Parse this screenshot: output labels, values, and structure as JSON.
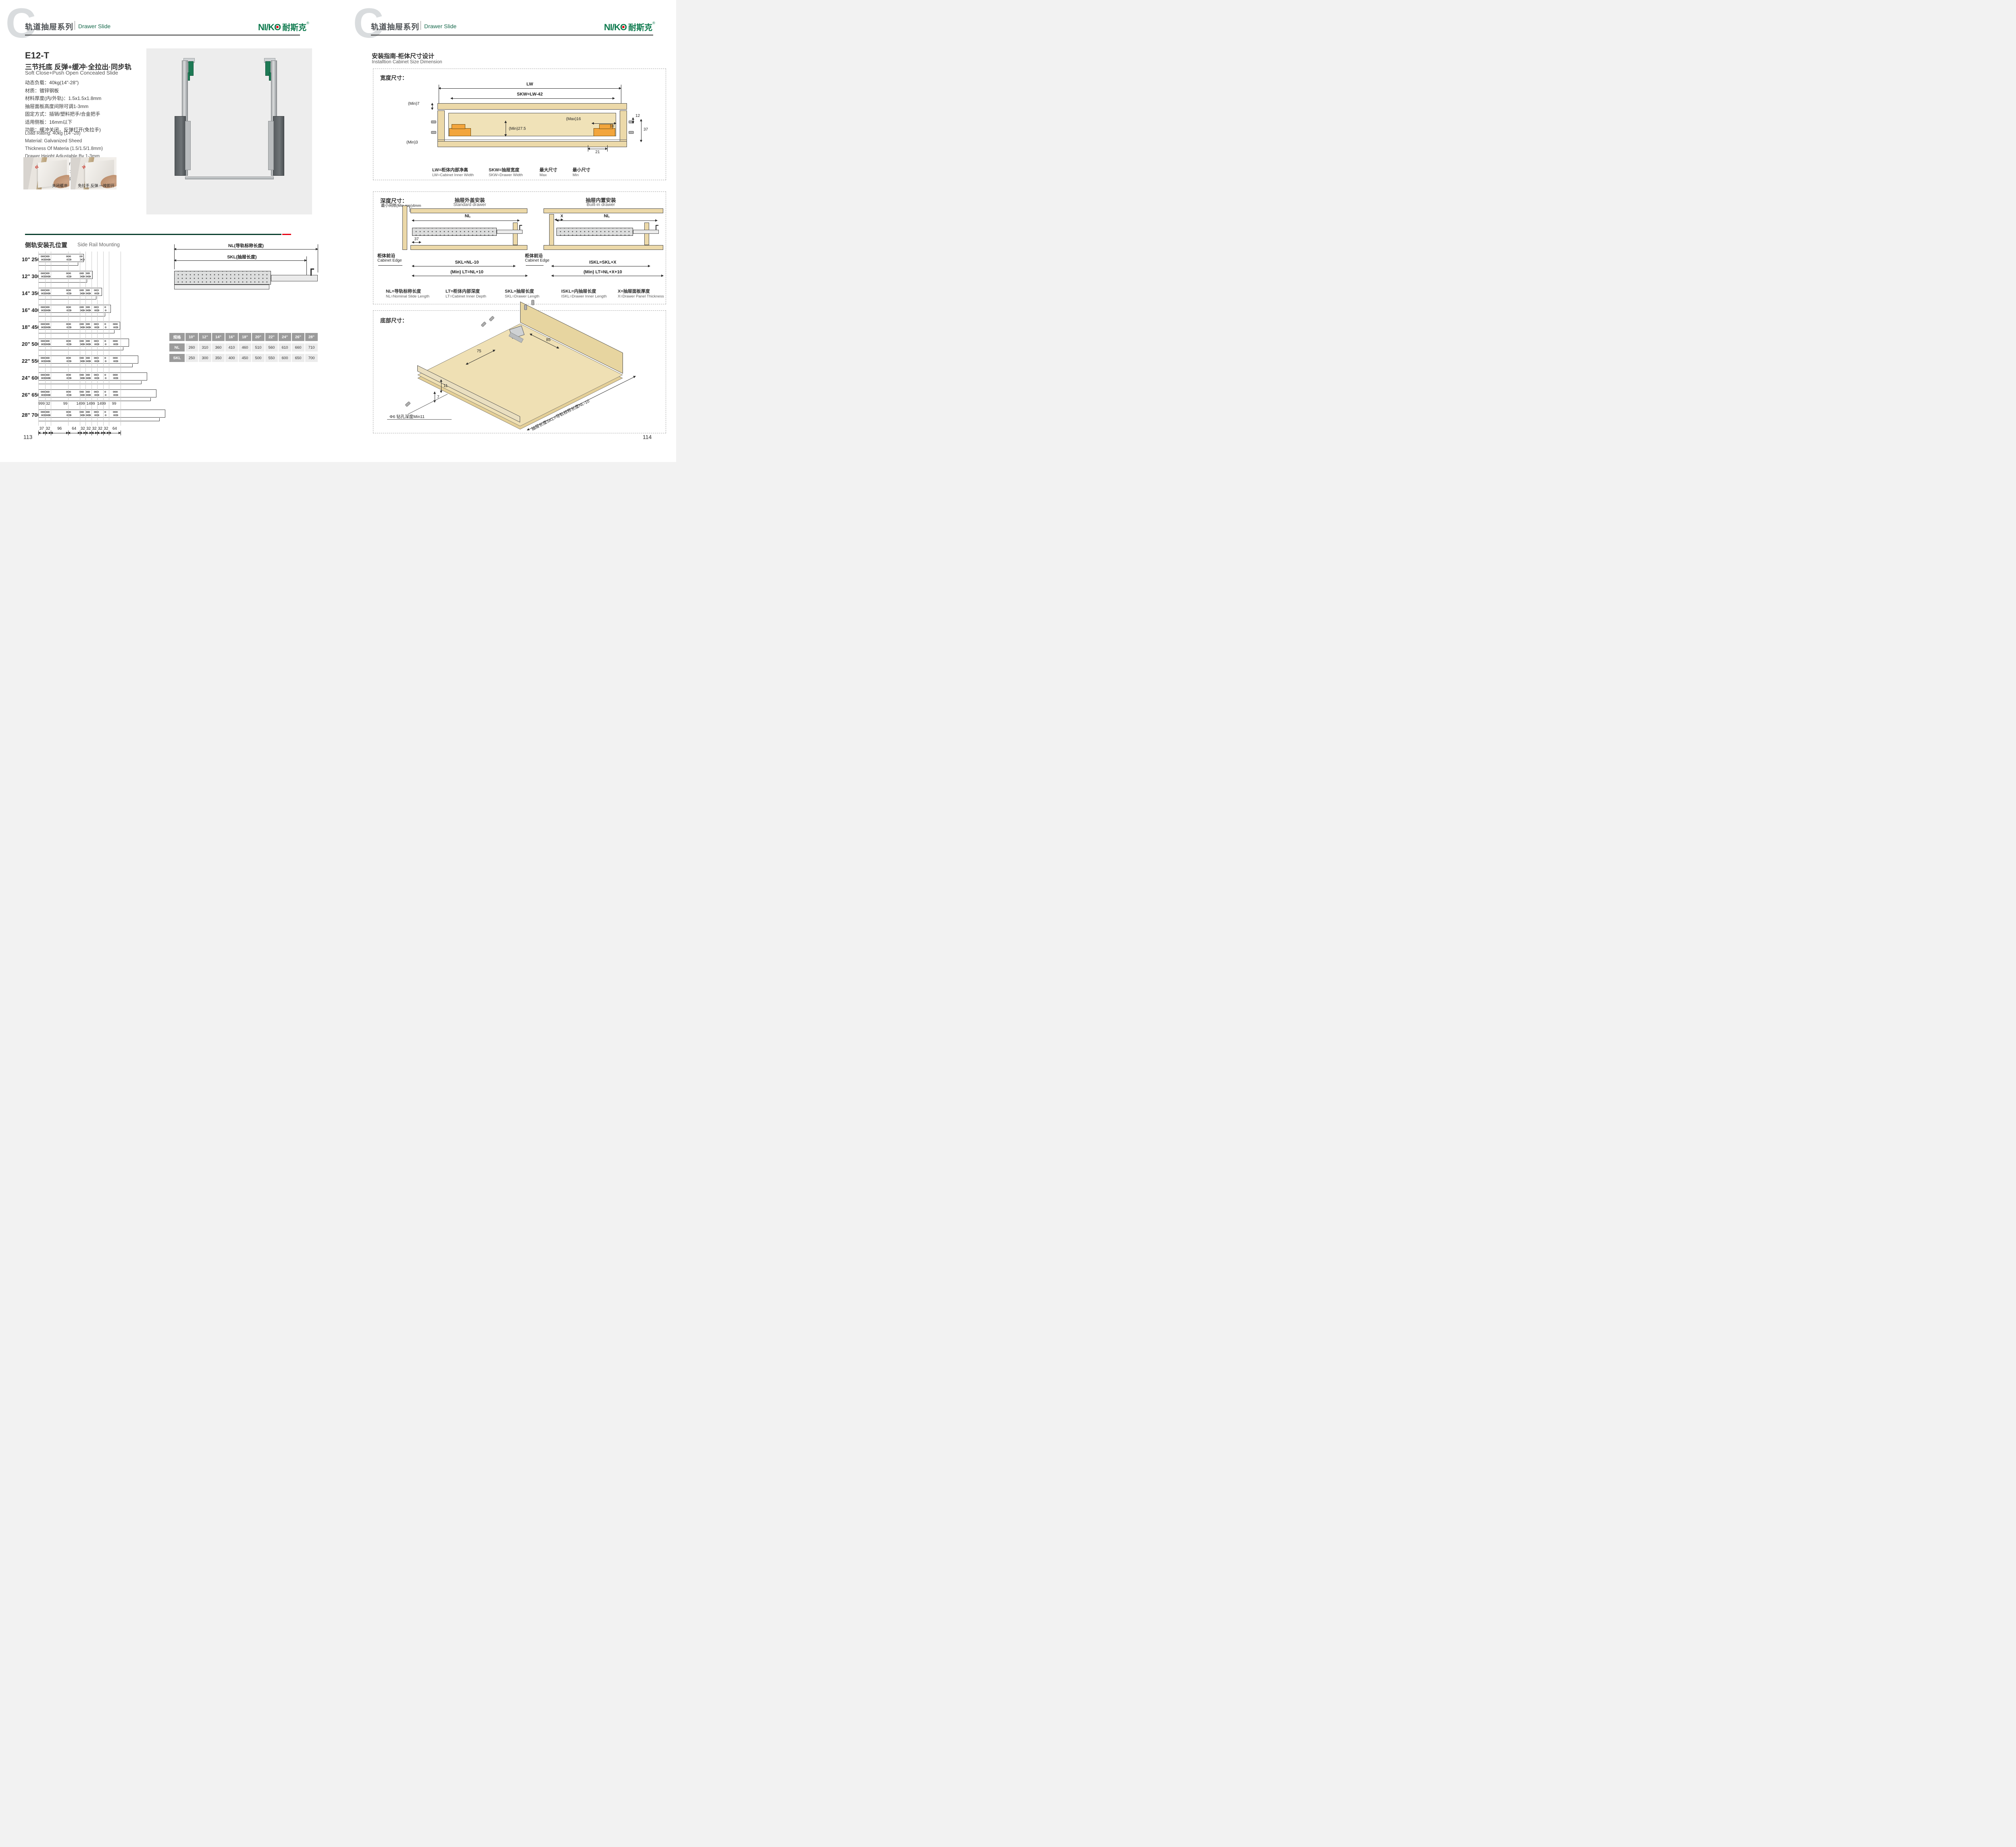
{
  "colors": {
    "brand_green": "#0e7a4e",
    "dark_green": "#0a3f2e",
    "accent_red": "#e60012",
    "wood": "#ecd9a9",
    "hardware_orange": "#f2a53c",
    "table_header_gray": "#9b9b9b",
    "table_cell_gray": "#ececec",
    "photo_gray": "#ededed"
  },
  "header": {
    "letter": "C",
    "series_cn": "轨道抽屉系列",
    "series_en": "Drawer Slide",
    "logo_latin": "NI/KO",
    "logo_cn": "耐斯克",
    "logo_reg": "®"
  },
  "left": {
    "model": "E12-T",
    "subtitle_cn": "三节托底 反弹+缓冲·全拉出·同步轨",
    "subtitle_en": "Soft Close+Push Open Concealed Slide",
    "specs_cn": [
      "动态负载：40kg(14\"-28\")",
      "材质：镀锌钢板",
      "材料厚度(内/外轨)：1.5x1.5x1.8mm",
      "抽屉面板高度间隙可调1-3mm",
      "固定方式：插销/塑料把手/合金把手",
      "适用侧板：16mm以下",
      "功能：缓冲关闭，反弹打开(免拉手)"
    ],
    "specs_en": [
      "Load Rating: 40kg (14\"-28)",
      "Material: Galvanized Sheed",
      "Thickness Of Materia (1.5/1.5/1.8mm)",
      "Drawer Height Adjustable By 1-3mm",
      "FIX：Screw/Plastic Bracket/Alloy Bracket",
      "Side Panel Thickness: 16mm",
      "Function: Soft Close, Push Open"
    ],
    "photo_captions": [
      "关闭缓冲",
      "免拉手 反弹 一按即开"
    ],
    "section_cn": "侧轨安装孔位置",
    "section_en": "Side Rail Mounting",
    "rails": [
      {
        "inch": "10\"",
        "mm": "250"
      },
      {
        "inch": "12\"",
        "mm": "300"
      },
      {
        "inch": "14\"",
        "mm": "350"
      },
      {
        "inch": "16\"",
        "mm": "400"
      },
      {
        "inch": "18\"",
        "mm": "450"
      },
      {
        "inch": "20\"",
        "mm": "500"
      },
      {
        "inch": "22\"",
        "mm": "550"
      },
      {
        "inch": "24\"",
        "mm": "600"
      },
      {
        "inch": "26\"",
        "mm": "650"
      },
      {
        "inch": "28\"",
        "mm": "700"
      }
    ],
    "mid_dims": [
      "999",
      "32",
      "99",
      "1499",
      "1499",
      "1499",
      "99"
    ],
    "bottom_dims": [
      "37",
      "32",
      "96",
      "64",
      "32",
      "32",
      "32",
      "32",
      "32",
      "64"
    ],
    "nl_label": "NL(导轨标称长度)",
    "skl_label": "SKL(抽屉长度)",
    "table": {
      "headers": [
        "规格",
        "10\"",
        "12\"",
        "14\"",
        "16\"",
        "18\"",
        "20\"",
        "22\"",
        "24\"",
        "26\"",
        "28\""
      ],
      "rows": [
        {
          "label": "NL",
          "values": [
            "260",
            "310",
            "360",
            "410",
            "460",
            "510",
            "560",
            "610",
            "660",
            "710"
          ]
        },
        {
          "label": "SKL",
          "values": [
            "250",
            "300",
            "350",
            "400",
            "450",
            "500",
            "550",
            "600",
            "650",
            "700"
          ]
        }
      ]
    },
    "page": "113"
  },
  "right": {
    "guide_cn": "安装指南-柜体尺寸设计",
    "guide_en": "Installtion Cabinet Size Dimension",
    "width": {
      "title": "宽度尺寸：",
      "lw": "LW",
      "skw": "SKW=LW-42",
      "min7": "(Min)7",
      "max16": "(Max)16",
      "d12": "12",
      "d10": "10",
      "d37": "37",
      "min27": "(Min)27.5",
      "min3": "(Min)3",
      "d21": "21",
      "legend": [
        {
          "cn": "LW=柜体内部净高",
          "en": "LW=Cabinet Inner Width"
        },
        {
          "cn": "SKW=抽屉宽度",
          "en": "SKW=Drawer  Width"
        },
        {
          "cn": "最大尺寸",
          "en": "Max"
        },
        {
          "cn": "最小尺寸",
          "en": "Min"
        }
      ]
    },
    "depth": {
      "title": "深度尺寸：",
      "min_gap": "最小间隙(Min gap)4mm",
      "std_cn": "抽屉外盖安装",
      "std_en": "Standard drawer",
      "builtin_cn": "抽屉内置安装",
      "builtin_en": "Built-in drawer",
      "nl": "NL",
      "d37": "37",
      "x": "X",
      "skl": "SKL=NL-10",
      "lt_std": "(Min) LT=NL+10",
      "iskl": "ISKL=SKL+X",
      "lt_bi": "(Min) LT=NL+X+10",
      "edge_cn": "柜体前沿",
      "edge_en": "Cabinet Edge",
      "legend": [
        {
          "cn": "NL=导轨标称长度",
          "en": "NL=Nominal Slide Length"
        },
        {
          "cn": "LT=柜体内部深度",
          "en": "LT=Cabinet Inner Depth"
        },
        {
          "cn": "SKL=抽屉长度",
          "en": "SKL=Drawer Length"
        },
        {
          "cn": "ISKL=内抽屉长度",
          "en": "ISKL=Drawer Inner Length"
        },
        {
          "cn": "X=抽屉面板厚度",
          "en": "X=Drawer Panel Thickness"
        }
      ]
    },
    "bottom": {
      "title": "底部尺寸：",
      "d75": "75",
      "d85": "85",
      "d11": "11",
      "d7": "7",
      "drill": "Φ6 钻孔深度Min11",
      "skl_note": "抽屉长度SKL=导轨标称长度NL-10"
    },
    "page": "114"
  }
}
